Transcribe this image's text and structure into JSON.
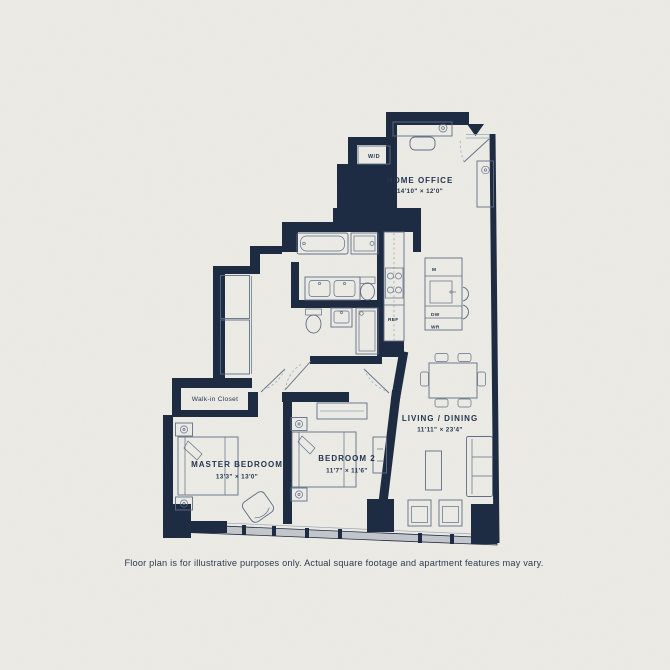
{
  "colors": {
    "background": "#ecebe5",
    "wall": "#1b2940",
    "furniture_line": "#5f6d84",
    "window_glass": "#c3c7cc",
    "text": "#22334e"
  },
  "rooms": {
    "home_office": {
      "label": "HOME OFFICE",
      "dimensions": "14'10\" × 12'0\""
    },
    "living_dining": {
      "label": "LIVING / DINING",
      "dimensions": "11'11\" × 23'4\""
    },
    "master_bedroom": {
      "label": "MASTER BEDROOM",
      "dimensions": "13'3\" × 13'0\""
    },
    "bedroom_2": {
      "label": "BEDROOM 2",
      "dimensions": "11'7\" × 11'6\""
    },
    "walk_in_closet": {
      "label": "Walk-in Closet"
    }
  },
  "appliances": {
    "washer_dryer": "W/D",
    "refrigerator": "REF",
    "microwave": "M",
    "dishwasher": "DW",
    "wine_cooler": "WR"
  },
  "footer": {
    "disclaimer": "Floor plan is for illustrative purposes only. Actual square footage and apartment features may vary."
  }
}
